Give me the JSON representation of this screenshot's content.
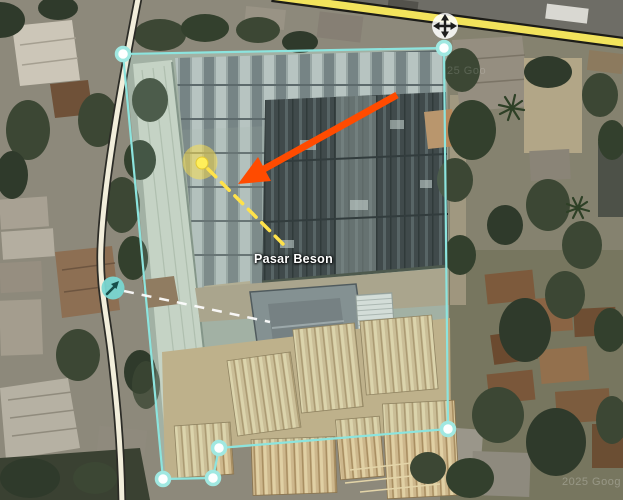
{
  "map": {
    "place_label": "Pasar Beson",
    "watermark_upper": "25 Goo",
    "watermark_lower": "2025 Goog",
    "imagery_type": "satellite"
  },
  "selection": {
    "stroke_color": "#8ce4de",
    "fill_color": "rgba(185,240,230,0.13)",
    "vertex_fill": "#fdffff",
    "vertex_ring": "#a0e8e1"
  },
  "annotations": {
    "arrow_color": "#ff4b00",
    "highlight_circle_color": "#ffe24a",
    "highlight_dot_color": "#ffef5a",
    "dashed_line_color": "#ffe24a",
    "guide_dash_color": "#ffffff"
  },
  "roads": {
    "primary_color": "#f2e35c",
    "secondary_color": "#f2eedb"
  },
  "icons": {
    "move_icon": "move-4-way-arrows",
    "marker_icon": "cursor-arrow-ne"
  }
}
